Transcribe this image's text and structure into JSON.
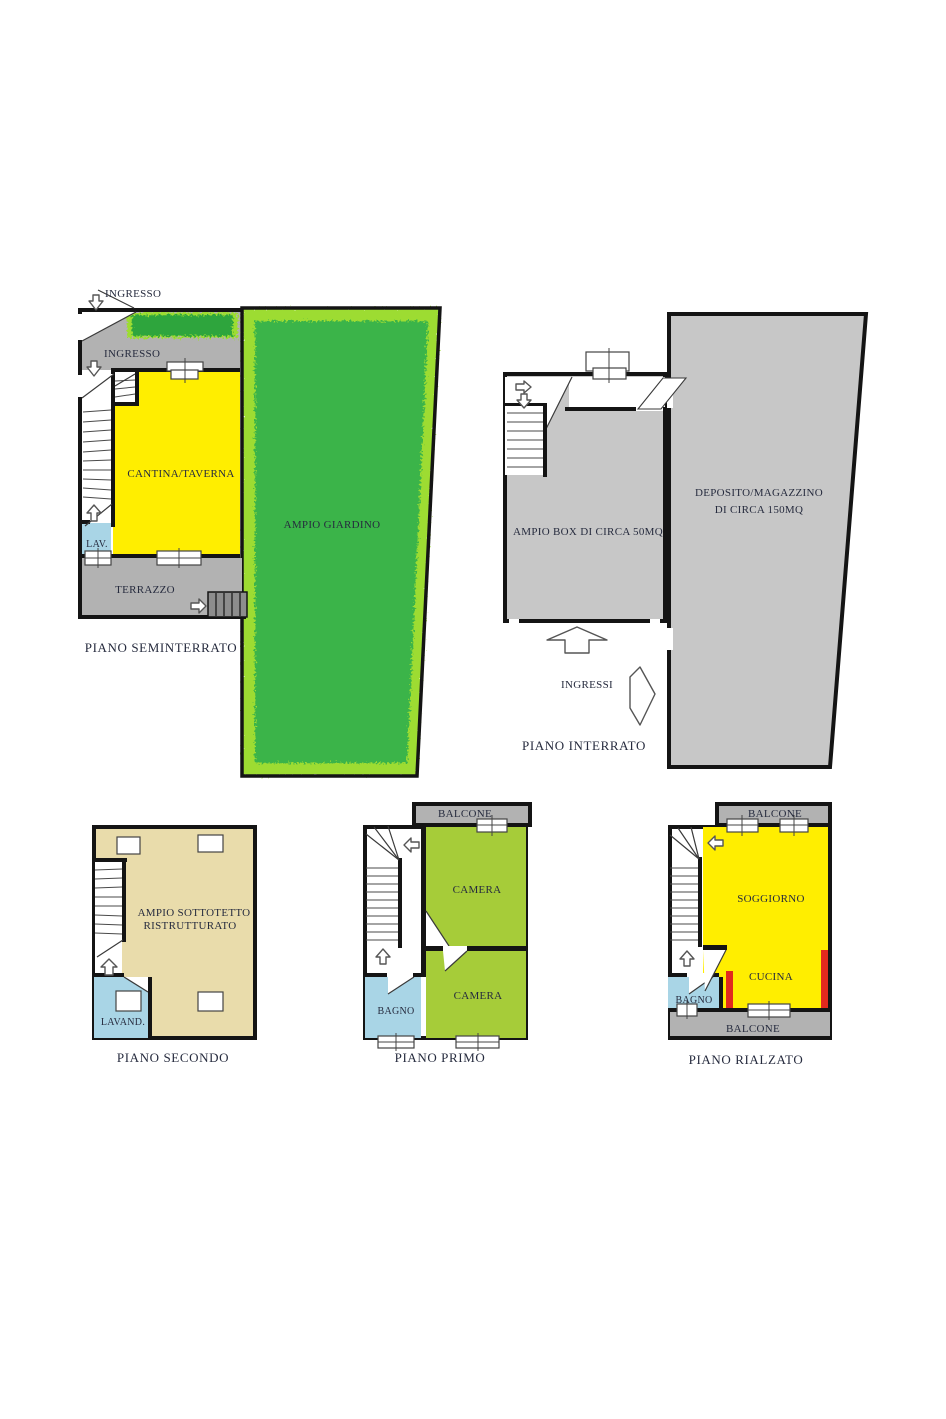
{
  "colors": {
    "wall": "#141414",
    "gray_area": "#b2b2b2",
    "gray_unit": "#c7c7c7",
    "yellow": "#ffee00",
    "lawn_green": "#3ab448",
    "hedge_green": "#9ddc30",
    "hedge_dark": "#2fa53c",
    "room_green": "#a6cc39",
    "blue": "#a9d5e6",
    "tan": "#e9dcab",
    "red": "#e12a1e",
    "steps_gray": "#8d8d8d",
    "white": "#ffffff"
  },
  "floors": {
    "seminterrato": {
      "title": "PIANO SEMINTERRATO",
      "ingresso_top": "INGRESSO",
      "ingresso_inner": "INGRESSO",
      "cantina": "CANTINA/TAVERNA",
      "lav": "LAV.",
      "terrazzo": "TERRAZZO",
      "giardino": "AMPIO GIARDINO"
    },
    "interrato": {
      "title": "PIANO INTERRATO",
      "box": "AMPIO BOX DI CIRCA 50MQ",
      "deposito_line1": "DEPOSITO/MAGAZZINO",
      "deposito_line2": "DI CIRCA 150MQ",
      "ingressi": "INGRESSI"
    },
    "secondo": {
      "title": "PIANO SECONDO",
      "sottotetto_line1": "AMPIO SOTTOTETTO",
      "sottotetto_line2": "RISTRUTTURATO",
      "lavanderia": "LAVAND."
    },
    "primo": {
      "title": "PIANO PRIMO",
      "balcone": "BALCONE",
      "camera_nord": "CAMERA",
      "camera_sud": "CAMERA",
      "bagno": "BAGNO"
    },
    "rialzato": {
      "title": "PIANO RIALZATO",
      "balcone_top": "BALCONE",
      "balcone_bottom": "BALCONE",
      "soggiorno": "SOGGIORNO",
      "cucina": "CUCINA",
      "bagno": "BAGNO"
    }
  }
}
